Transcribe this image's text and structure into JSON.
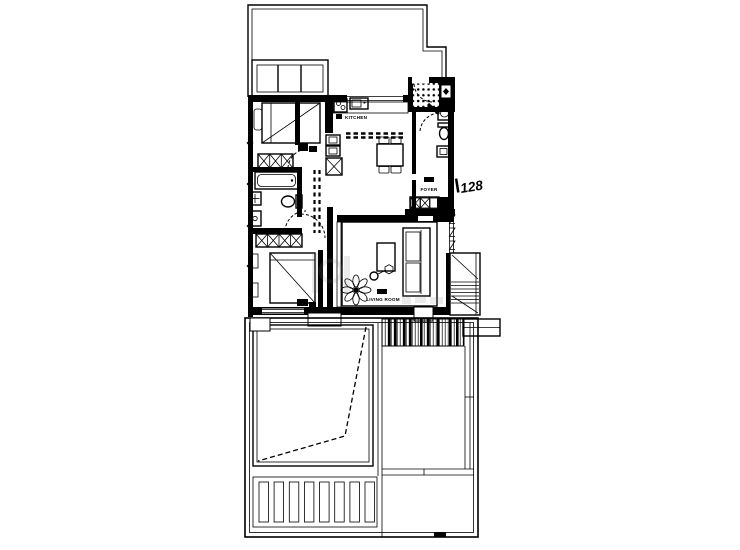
{
  "drawing": {
    "background_color": "#ffffff",
    "line_color": "#000000",
    "watermark_color": "#808080"
  },
  "labels": {
    "kitchen": "KITCHEN",
    "foyer": "FOYER",
    "living_room": "LIVING ROOM",
    "unit_number": "128"
  },
  "icons": {
    "wardrobe-icon": "crossed-box",
    "refrigerator-icon": "crossed-box",
    "bed-icon": "rectangle-with-diagonal",
    "bathtub-icon": "rounded-inner-rectangle",
    "toilet-icon": "tank-and-bowl",
    "sink-icon": "box-with-basin",
    "stove-icon": "box-with-burners",
    "dining-table-icon": "table-with-chairs",
    "sofa-icon": "box-with-cushions",
    "coffee-table-icon": "small-rectangle",
    "plant-icon": "petal-rosette",
    "staircase-icon": "treads-with-diagonals",
    "door-swing-icon": "dashed-quarter-arc",
    "entry-mat-icon": "dot-grid",
    "deck-icon": "vertical-hatch"
  }
}
